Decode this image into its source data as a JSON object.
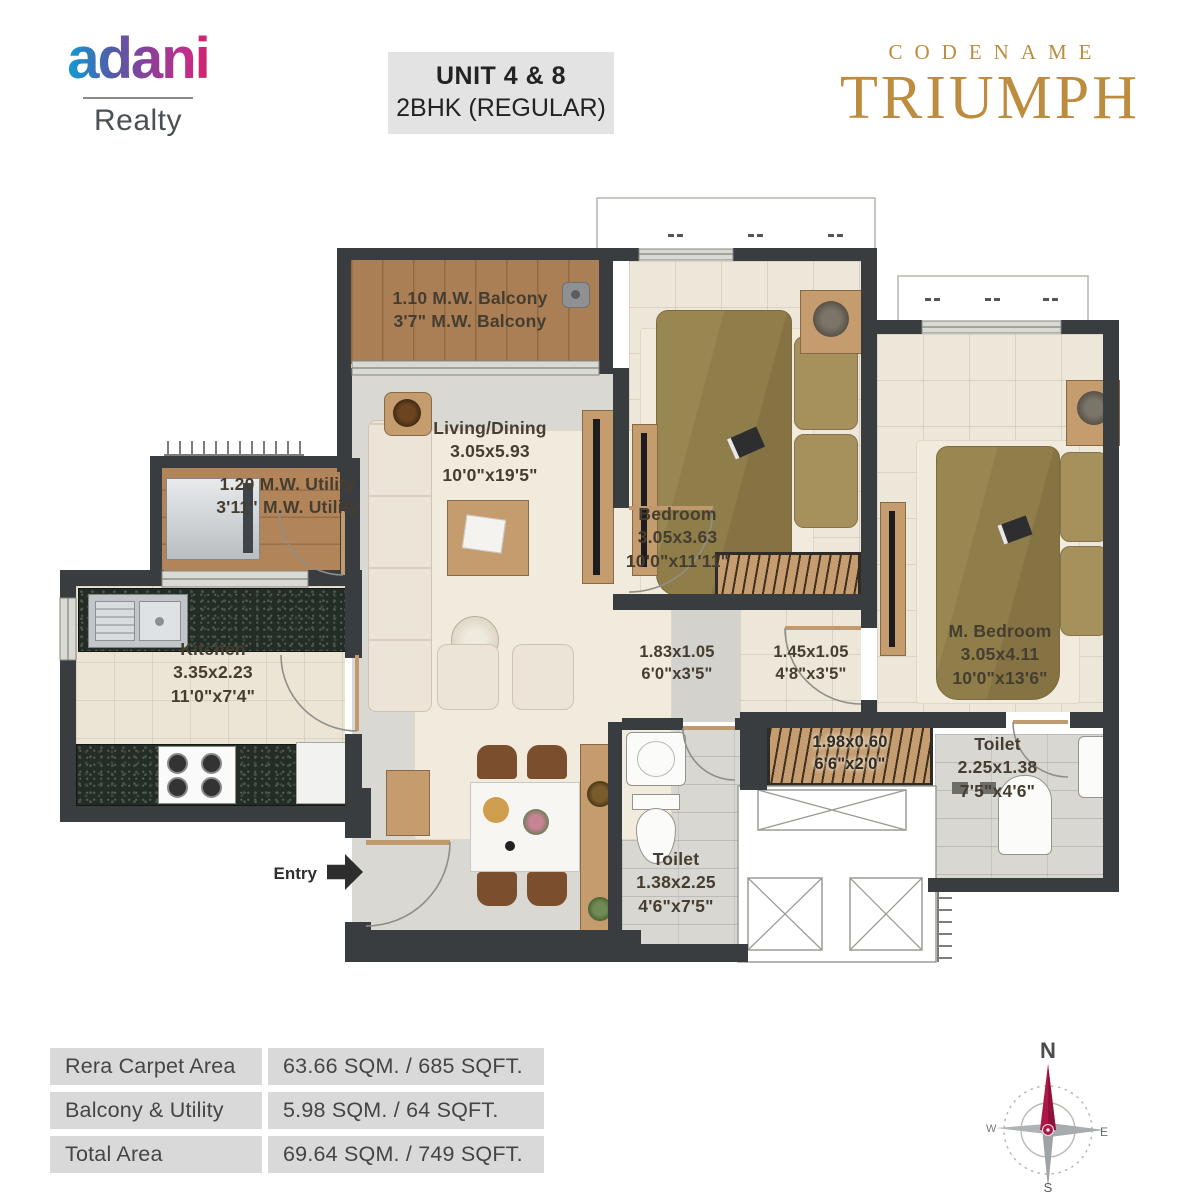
{
  "header": {
    "logo": {
      "brand": "adani",
      "division": "Realty"
    },
    "unit": {
      "line1": "UNIT 4 & 8",
      "line2": "2BHK (REGULAR)"
    },
    "project": {
      "eyebrow": "CODENAME",
      "name": "TRIUMPH"
    }
  },
  "plan": {
    "balcony": {
      "line1": "1.10 M.W. Balcony",
      "line2": "3'7\" M.W. Balcony"
    },
    "utility": {
      "line1": "1.20 M.W. Utility",
      "line2": "3'11\" M.W. Utility"
    },
    "living": {
      "name": "Living/Dining",
      "dim_m": "3.05x5.93",
      "dim_ft": "10'0\"x19'5\""
    },
    "bedroom": {
      "name": "Bedroom",
      "dim_m": "3.05x3.63",
      "dim_ft": "10'0\"x11'11\""
    },
    "master_bedroom": {
      "name": "M. Bedroom",
      "dim_m": "3.05x4.11",
      "dim_ft": "10'0\"x13'6\""
    },
    "kitchen": {
      "name": "Kitchen",
      "dim_m": "3.35x2.23",
      "dim_ft": "11'0\"x7'4\""
    },
    "passage1": {
      "dim_m": "1.83x1.05",
      "dim_ft": "6'0\"x3'5\""
    },
    "passage2": {
      "dim_m": "1.45x1.05",
      "dim_ft": "4'8\"x3'5\""
    },
    "wardrobe": {
      "dim_m": "1.98x0.60",
      "dim_ft": "6'6\"x2'0\""
    },
    "toilet_common": {
      "name": "Toilet",
      "dim_m": "1.38x2.25",
      "dim_ft": "4'6\"x7'5\""
    },
    "toilet_master": {
      "name": "Toilet",
      "dim_m": "2.25x1.38",
      "dim_ft": "7'5\"x4'6\""
    },
    "entry": "Entry"
  },
  "areas": {
    "rows": [
      {
        "label": "Rera Carpet Area",
        "value": "63.66 SQM. / 685 SQFT."
      },
      {
        "label": "Balcony & Utility",
        "value": "5.98 SQM. / 64 SQFT."
      },
      {
        "label": "Total Area",
        "value": "69.64 SQM. / 749 SQFT."
      }
    ]
  },
  "compass": {
    "north": "N",
    "east": "E",
    "south": "S",
    "west": "W"
  },
  "colors": {
    "wall": "#3a3d3f",
    "wood": "#b3885e",
    "brand_gold": "#bd8c3f",
    "compass_north": "#b01747",
    "logo_gradient_start": "#00a9e0",
    "logo_gradient_end": "#d81f5f"
  }
}
